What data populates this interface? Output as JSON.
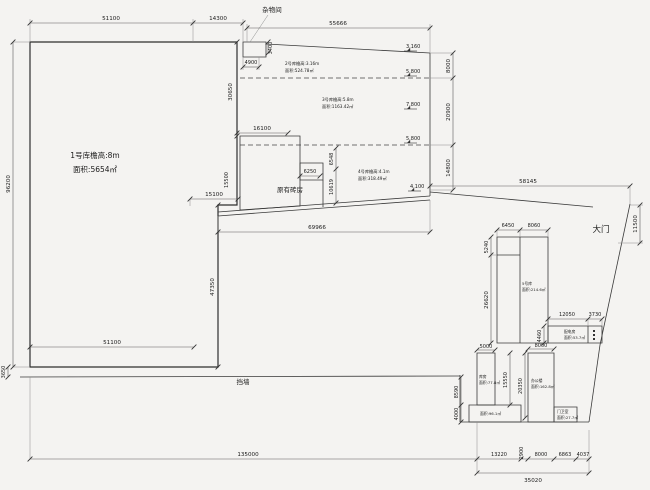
{
  "site_labels": {
    "storage_room": "杂物间",
    "existing_brick_house": "原有砖房",
    "retaining_wall": "挡墙",
    "main_gate": "大门"
  },
  "buildings": {
    "w1": {
      "l1": "1号库檐高:8m",
      "l2": "面积:5654㎡"
    },
    "w2": {
      "l1": "2号库檐高:3.16m",
      "l2": "面积:524.78㎡"
    },
    "w3": {
      "l1": "3号库檐高:5.8m",
      "l2": "面积:1163.42㎡"
    },
    "w4": {
      "l1": "4号库檐高:4.1m",
      "l2": "面积:318.49㎡"
    },
    "w5": {
      "l1": "5号库",
      "l2": "面积:214.6㎡"
    },
    "power": {
      "l1": "配电房",
      "l2": "面积:53.7㎡"
    },
    "store": {
      "l1": "库房",
      "l2": "面积:77.8㎡"
    },
    "annex": {
      "l1": "面积:96.1㎡"
    },
    "office": {
      "l1": "办公楼",
      "l2": "面积:162.8㎡"
    },
    "guard": {
      "l1": "门卫室",
      "l2": "面积:27.7㎡"
    }
  },
  "elevations": {
    "e1": "3.160",
    "e2": "5.800",
    "e3": "7.800",
    "e4": "5.800",
    "e5": "4.100"
  },
  "dims": {
    "top_51100": "51100",
    "top_14300": "14300",
    "top_55666": "55666",
    "shed_4900": "4900",
    "shed_3400": "3400",
    "left_96200": "96200",
    "left_3650": "3650",
    "wall_30650": "30650",
    "right_8000": "8000",
    "right_20900": "20900",
    "right_14800": "14800",
    "mid_16100": "16100",
    "mid_15100": "15100",
    "mid_15500": "15500",
    "mid_6250": "6250",
    "mid_6548": "6548",
    "mid_10619": "10619",
    "mid_47350": "47350",
    "bottom_69966": "69966",
    "gate_58145": "58145",
    "gate_11500": "11500",
    "yard_6450": "6450",
    "yard_8060": "8060",
    "yard_5240": "5240",
    "yard_26620": "26620",
    "yard_12050": "12050",
    "yard_3730": "3730",
    "yard_4460": "4460",
    "low_5000": "5000",
    "low_15550": "15550",
    "low_8590": "8590",
    "low_4000": "4000",
    "low_8000": "8000",
    "low_20350": "20350",
    "base_135000": "135000",
    "base_13220": "13220",
    "base_2900": "2900",
    "base_8000": "8000",
    "base_6863": "6863",
    "base_4037": "4037",
    "base_35020": "35020",
    "base_51100": "51100"
  },
  "colors": {
    "wall": "#2e2e2e",
    "dimension": "#5a5a5a",
    "background": "#f4f3f1"
  }
}
